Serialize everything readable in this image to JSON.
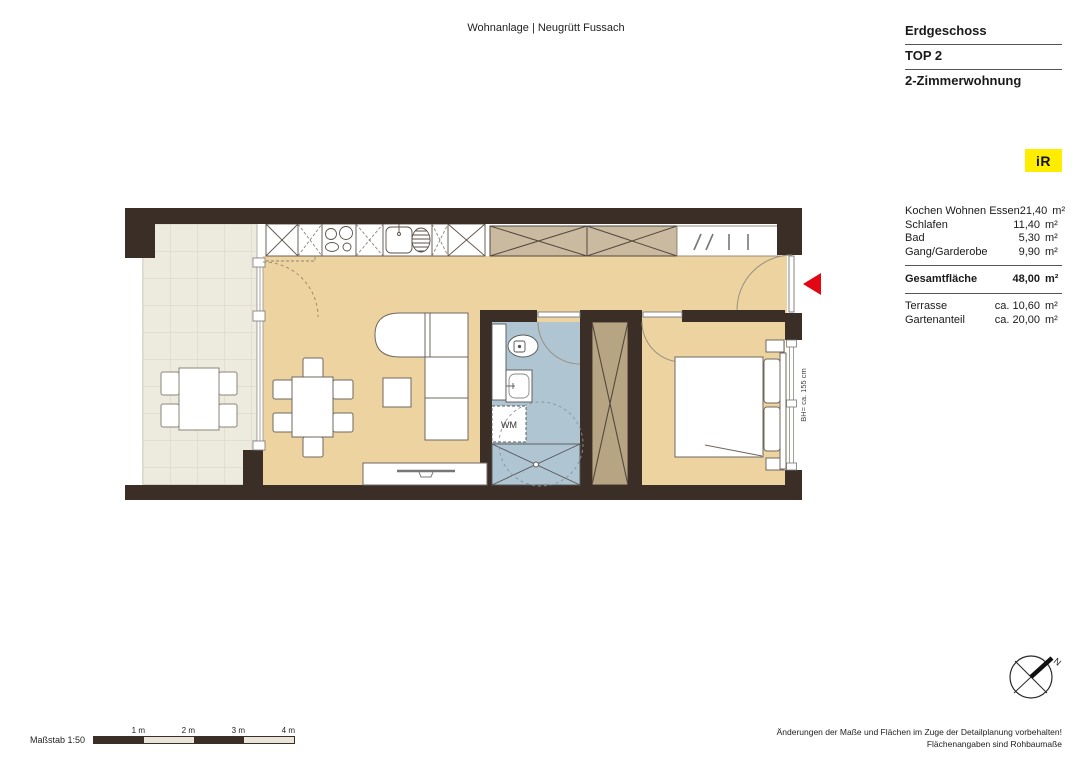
{
  "header": {
    "project_title": "Wohnanlage | Neugrütt Fussach"
  },
  "title_block": {
    "floor": "Erdgeschoss",
    "unit": "TOP 2",
    "apartment_type": "2-Zimmerwohnung"
  },
  "logo": {
    "text": "iR",
    "bg_color": "#ffed00"
  },
  "area_table": {
    "rows": [
      {
        "label": "Kochen Wohnen Essen",
        "value": "21,40",
        "unit": "m²"
      },
      {
        "label": "Schlafen",
        "value": "11,40",
        "unit": "m²"
      },
      {
        "label": "Bad",
        "value": "5,30",
        "unit": "m²"
      },
      {
        "label": "Gang/Garderobe",
        "value": "9,90",
        "unit": "m²"
      }
    ],
    "total": {
      "label": "Gesamtfläche",
      "value": "48,00",
      "unit": "m²"
    },
    "extras": [
      {
        "label": "Terrasse",
        "value": "ca. 10,60",
        "unit": "m²"
      },
      {
        "label": "Gartenanteil",
        "value": "ca. 20,00",
        "unit": "m²"
      }
    ]
  },
  "plan": {
    "labels": {
      "washing_machine": "WM",
      "window_sill_height": "BH= ca. 155 cm"
    },
    "colors": {
      "wall": "#3b2e27",
      "floor_living": "#edd3a0",
      "floor_terrace": "#edeade",
      "floor_bath": "#b0c5d2",
      "shaft_fill": "#b7a482",
      "wardrobe_fill": "#c9baa0",
      "entrance_arrow": "#e30613"
    }
  },
  "compass": {
    "north_label": "N"
  },
  "footer": {
    "scale_label": "Maßstab 1:50",
    "scale_ticks": [
      "1 m",
      "2 m",
      "3 m",
      "4 m"
    ],
    "note_line1": "Änderungen der Maße und Flächen im Zuge der Detailplanung vorbehalten!",
    "note_line2": "Flächenangaben sind Rohbaumaße"
  }
}
